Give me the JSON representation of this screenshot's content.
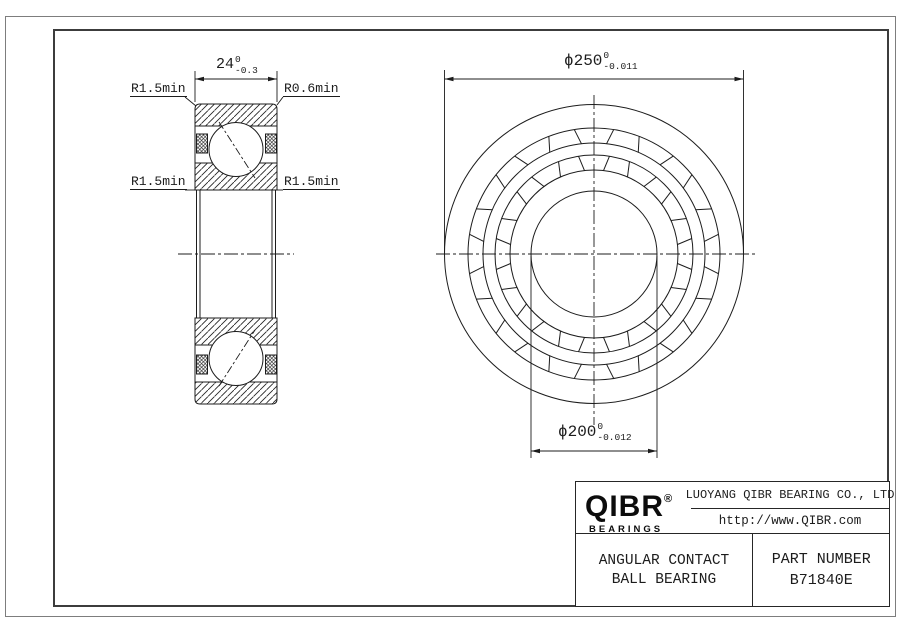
{
  "section_view": {
    "width_dim": {
      "value": "24",
      "tol_top": "0",
      "tol_bottom": "-0.3"
    },
    "radius_labels": {
      "top_left": "R1.5min",
      "top_right": "R0.6min",
      "mid_left": "R1.5min",
      "mid_right": "R1.5min"
    }
  },
  "front_view": {
    "outer_dia": {
      "value": "ϕ250",
      "tol_top": "0",
      "tol_bottom": "-0.011"
    },
    "bore_dia": {
      "value": "ϕ200",
      "tol_top": "0",
      "tol_bottom": "-0.012"
    }
  },
  "title_block": {
    "logo_text": "QIBR",
    "logo_registered": "®",
    "logo_sub": "BEARINGS",
    "company_name": "LUOYANG QIBR BEARING CO., LTD",
    "website": "http://www.QIBR.com",
    "product_type_line1": "ANGULAR CONTACT",
    "product_type_line2": "BALL BEARING",
    "part_number_label": "PART NUMBER",
    "part_number": "B71840E"
  },
  "colors": {
    "line": "#1c1c1c",
    "frame": "#3c3c3c",
    "outer_border": "#7d7d7d"
  }
}
